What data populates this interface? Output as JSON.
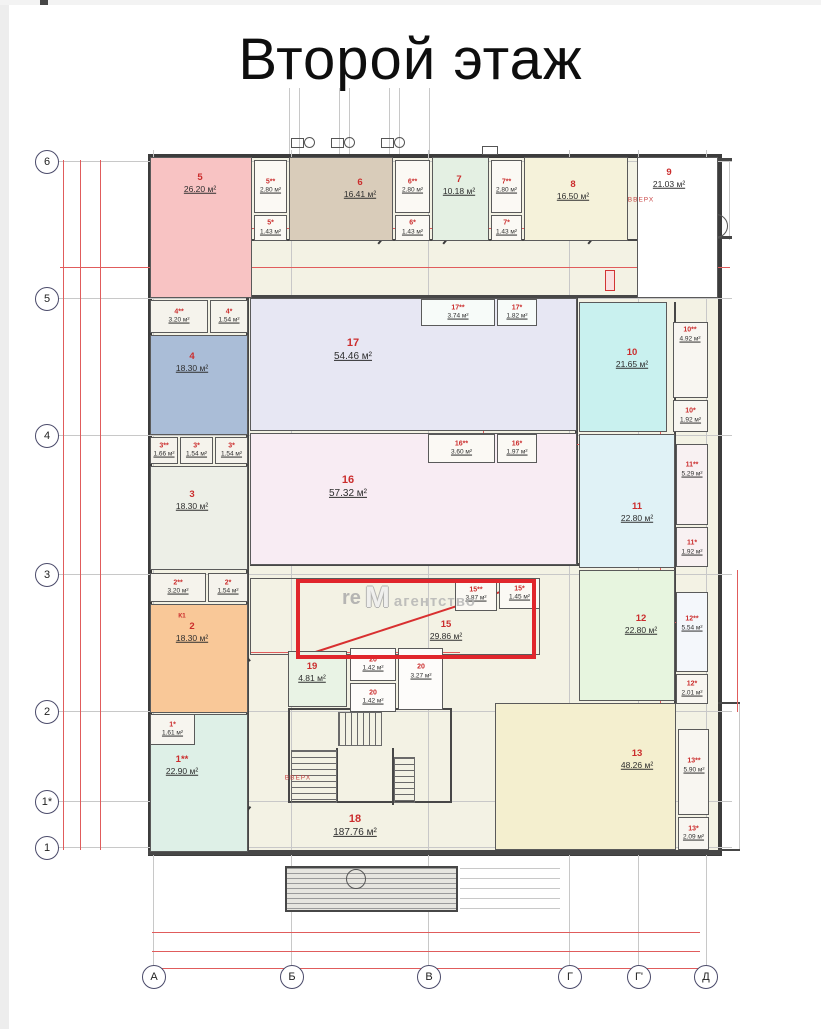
{
  "title": "Второй этаж",
  "watermark": {
    "prefix": "re",
    "logo": "M",
    "name": "агентство"
  },
  "highlight": {
    "x": 296,
    "y": 579,
    "w": 240,
    "h": 80
  },
  "axis": {
    "rows": [
      {
        "label": "6",
        "y": 162
      },
      {
        "label": "5",
        "y": 299
      },
      {
        "label": "4",
        "y": 436
      },
      {
        "label": "3",
        "y": 575
      },
      {
        "label": "2",
        "y": 712
      },
      {
        "label": "1*",
        "y": 802
      },
      {
        "label": "1",
        "y": 848
      }
    ],
    "cols": [
      {
        "label": "А",
        "x": 154
      },
      {
        "label": "Б",
        "x": 292
      },
      {
        "label": "В",
        "x": 429
      },
      {
        "label": "Г",
        "x": 570
      },
      {
        "label": "Г'",
        "x": 639
      },
      {
        "label": "Д",
        "x": 706
      }
    ]
  },
  "texts": [
    {
      "t": "ВВЕРХ",
      "x": 641,
      "y": 200,
      "cls": "vverh"
    },
    {
      "t": "ВВЕРХ",
      "x": 298,
      "y": 778,
      "cls": "vverh"
    },
    {
      "t": "К1",
      "x": 182,
      "y": 616,
      "cls": "k1"
    }
  ],
  "rooms": [
    {
      "n": "18",
      "a": "187.76 м²",
      "x": 250,
      "y": 565,
      "w": 427,
      "h": 287,
      "bg": "transparent",
      "lx": 355,
      "ly": 826,
      "sz": "l",
      "nb": true
    },
    {
      "n": "15",
      "a": "29.86 м²",
      "x": 250,
      "y": 578,
      "w": 290,
      "h": 77,
      "bg": "transparent",
      "lx": 446,
      "ly": 630,
      "sz": "m"
    },
    {
      "n": "5",
      "a": "26.20 м²",
      "x": 150,
      "y": 157,
      "w": 102,
      "h": 141,
      "bg": "#f8c3c3",
      "lx": 200,
      "ly": 183,
      "sz": "m"
    },
    {
      "n": "5**",
      "a": "2.80 м²",
      "x": 254,
      "y": 160,
      "w": 33,
      "h": 53,
      "bg": "#fbf9f4",
      "sz": "s"
    },
    {
      "n": "5*",
      "a": "1.43 м²",
      "x": 254,
      "y": 215,
      "w": 33,
      "h": 26,
      "bg": "#fbf9f4",
      "sz": "s"
    },
    {
      "n": "6",
      "a": "16.41 м²",
      "x": 289,
      "y": 157,
      "w": 104,
      "h": 84,
      "bg": "#d9ccba",
      "lx": 360,
      "ly": 188,
      "sz": "m"
    },
    {
      "n": "6**",
      "a": "2.80 м²",
      "x": 395,
      "y": 160,
      "w": 35,
      "h": 53,
      "bg": "#fbf9f4",
      "sz": "s"
    },
    {
      "n": "6*",
      "a": "1.43 м²",
      "x": 395,
      "y": 215,
      "w": 35,
      "h": 26,
      "bg": "#fbf9f4",
      "sz": "s"
    },
    {
      "n": "7",
      "a": "10.18 м²",
      "x": 432,
      "y": 157,
      "w": 57,
      "h": 84,
      "bg": "#e4f0e3",
      "lx": 459,
      "ly": 185,
      "sz": "m"
    },
    {
      "n": "7**",
      "a": "2.80 м²",
      "x": 491,
      "y": 160,
      "w": 31,
      "h": 53,
      "bg": "#fbf9f4",
      "sz": "s"
    },
    {
      "n": "7*",
      "a": "1.43 м²",
      "x": 491,
      "y": 215,
      "w": 31,
      "h": 26,
      "bg": "#fbf9f4",
      "sz": "s"
    },
    {
      "n": "8",
      "a": "16.50 м²",
      "x": 524,
      "y": 157,
      "w": 104,
      "h": 84,
      "bg": "#f5f2da",
      "lx": 573,
      "ly": 190,
      "sz": "m"
    },
    {
      "n": "9",
      "a": "21.03 м²",
      "x": 637,
      "y": 157,
      "w": 81,
      "h": 141,
      "bg": "#ffffff",
      "lx": 669,
      "ly": 178,
      "sz": "m"
    },
    {
      "n": "4**",
      "a": "3.20 м²",
      "x": 150,
      "y": 300,
      "w": 58,
      "h": 33,
      "bg": "#f5f3ec",
      "sz": "s"
    },
    {
      "n": "4*",
      "a": "1.54 м²",
      "x": 210,
      "y": 300,
      "w": 38,
      "h": 33,
      "bg": "#f5f3ec",
      "sz": "s"
    },
    {
      "n": "4",
      "a": "18.30 м²",
      "x": 150,
      "y": 335,
      "w": 98,
      "h": 100,
      "bg": "#aabdd7",
      "lx": 192,
      "ly": 362,
      "sz": "m"
    },
    {
      "n": "3**",
      "a": "1.66 м²",
      "x": 150,
      "y": 437,
      "w": 28,
      "h": 27,
      "bg": "#f5f3ec",
      "sz": "s"
    },
    {
      "n": "3*",
      "a": "1.54 м²",
      "x": 180,
      "y": 437,
      "w": 33,
      "h": 27,
      "bg": "#f5f3ec",
      "sz": "s"
    },
    {
      "n": "3*",
      "a": "1.54 м²",
      "x": 215,
      "y": 437,
      "w": 33,
      "h": 27,
      "bg": "#f5f3ec",
      "sz": "s"
    },
    {
      "n": "3",
      "a": "18.30 м²",
      "x": 150,
      "y": 466,
      "w": 98,
      "h": 104,
      "bg": "#edefe7",
      "lx": 192,
      "ly": 500,
      "sz": "m"
    },
    {
      "n": "2**",
      "a": "3.20 м²",
      "x": 150,
      "y": 573,
      "w": 56,
      "h": 29,
      "bg": "#f5f3ec",
      "sz": "s"
    },
    {
      "n": "2*",
      "a": "1.54 м²",
      "x": 208,
      "y": 573,
      "w": 40,
      "h": 29,
      "bg": "#f5f3ec",
      "sz": "s"
    },
    {
      "n": "2",
      "a": "18.30 м²",
      "x": 150,
      "y": 604,
      "w": 98,
      "h": 109,
      "bg": "#f9c898",
      "lx": 192,
      "ly": 632,
      "sz": "m"
    },
    {
      "n": "1**",
      "a": "22.90 м²",
      "x": 150,
      "y": 714,
      "w": 98,
      "h": 138,
      "bg": "#def0e7",
      "lx": 182,
      "ly": 765,
      "sz": "m"
    },
    {
      "n": "1*",
      "a": "1.61 м²",
      "x": 150,
      "y": 714,
      "w": 45,
      "h": 31,
      "bg": "#f7f5ef",
      "sz": "s"
    },
    {
      "n": "17",
      "a": "54.46 м²",
      "x": 250,
      "y": 298,
      "w": 327,
      "h": 133,
      "bg": "#e7e7f3",
      "lx": 353,
      "ly": 350,
      "sz": "l"
    },
    {
      "n": "17**",
      "a": "3.74 м²",
      "x": 421,
      "y": 299,
      "w": 74,
      "h": 27,
      "bg": "#f7fbf9",
      "sz": "s"
    },
    {
      "n": "17*",
      "a": "1.82 м²",
      "x": 497,
      "y": 299,
      "w": 40,
      "h": 27,
      "bg": "#f7fbf9",
      "sz": "s"
    },
    {
      "n": "16",
      "a": "57.32 м²",
      "x": 250,
      "y": 433,
      "w": 327,
      "h": 132,
      "bg": "#f8ecf3",
      "lx": 348,
      "ly": 487,
      "sz": "l"
    },
    {
      "n": "16**",
      "a": "3.60 м²",
      "x": 428,
      "y": 434,
      "w": 67,
      "h": 29,
      "bg": "#fbf9f4",
      "sz": "s"
    },
    {
      "n": "16*",
      "a": "1.97 м²",
      "x": 497,
      "y": 434,
      "w": 40,
      "h": 29,
      "bg": "#fbf9f4",
      "sz": "s"
    },
    {
      "n": "10",
      "a": "21.65 м²",
      "x": 579,
      "y": 302,
      "w": 88,
      "h": 130,
      "bg": "#c9f1ef",
      "lx": 632,
      "ly": 358,
      "sz": "m"
    },
    {
      "n": "10**",
      "a": "4.92 м²",
      "x": 673,
      "y": 322,
      "w": 35,
      "h": 76,
      "bg": "#f8f6f1",
      "lx": 690,
      "ly": 335,
      "sz": "s"
    },
    {
      "n": "10*",
      "a": "1.92 м²",
      "x": 673,
      "y": 400,
      "w": 35,
      "h": 32,
      "bg": "#f8f6f1",
      "sz": "s"
    },
    {
      "n": "11",
      "a": "22.80 м²",
      "x": 579,
      "y": 434,
      "w": 96,
      "h": 134,
      "bg": "#e0f2f6",
      "lx": 637,
      "ly": 512,
      "sz": "m"
    },
    {
      "n": "11**",
      "a": "5.29 м²",
      "x": 676,
      "y": 444,
      "w": 32,
      "h": 81,
      "bg": "#f8f1f2",
      "lx": 692,
      "ly": 470,
      "sz": "s"
    },
    {
      "n": "11*",
      "a": "1.92 м²",
      "x": 676,
      "y": 527,
      "w": 32,
      "h": 40,
      "bg": "#f8f1f2",
      "lx": 692,
      "ly": 548,
      "sz": "s"
    },
    {
      "n": "12",
      "a": "22.80 м²",
      "x": 579,
      "y": 570,
      "w": 96,
      "h": 131,
      "bg": "#e7f5df",
      "lx": 641,
      "ly": 624,
      "sz": "m"
    },
    {
      "n": "12**",
      "a": "5.54 м²",
      "x": 676,
      "y": 592,
      "w": 32,
      "h": 80,
      "bg": "#f4f7fb",
      "lx": 692,
      "ly": 624,
      "sz": "s"
    },
    {
      "n": "12*",
      "a": "2.01 м²",
      "x": 676,
      "y": 674,
      "w": 32,
      "h": 30,
      "bg": "#f8f6f1",
      "sz": "s"
    },
    {
      "n": "13",
      "a": "48.26 м²",
      "x": 495,
      "y": 703,
      "w": 181,
      "h": 147,
      "bg": "#f4efcf",
      "lx": 637,
      "ly": 759,
      "sz": "m"
    },
    {
      "n": "13**",
      "a": "5.90 м²",
      "x": 678,
      "y": 729,
      "w": 31,
      "h": 86,
      "bg": "#f8f6f1",
      "lx": 694,
      "ly": 766,
      "sz": "s"
    },
    {
      "n": "13*",
      "a": "2.09 м²",
      "x": 678,
      "y": 817,
      "w": 31,
      "h": 33,
      "bg": "#f8f6f1",
      "sz": "s"
    },
    {
      "n": "15**",
      "a": "3.87 м²",
      "x": 455,
      "y": 578,
      "w": 42,
      "h": 33,
      "bg": "#fbf9f4",
      "sz": "s"
    },
    {
      "n": "15*",
      "a": "1.45 м²",
      "x": 499,
      "y": 578,
      "w": 41,
      "h": 31,
      "bg": "#fbf9f4",
      "sz": "s"
    },
    {
      "n": "19",
      "a": "4.81 м²",
      "x": 288,
      "y": 651,
      "w": 59,
      "h": 56,
      "bg": "#e9f3e5",
      "lx": 312,
      "ly": 672,
      "sz": "m"
    },
    {
      "n": "20",
      "a": "1.42 м²",
      "x": 350,
      "y": 648,
      "w": 46,
      "h": 33,
      "bg": "#fdfcfa",
      "sz": "s"
    },
    {
      "n": "20",
      "a": "1.42 м²",
      "x": 350,
      "y": 683,
      "w": 46,
      "h": 29,
      "bg": "#fdfcfa",
      "sz": "s"
    },
    {
      "n": "20",
      "a": "3.27 м²",
      "x": 398,
      "y": 648,
      "w": 45,
      "h": 62,
      "bg": "#fdfcfa",
      "lx": 421,
      "ly": 672,
      "sz": "s"
    }
  ],
  "shapes": [
    {
      "c": "g",
      "x": 58,
      "y": 161,
      "w": 674,
      "h": 1
    },
    {
      "c": "g",
      "x": 58,
      "y": 298,
      "w": 674,
      "h": 1
    },
    {
      "c": "g",
      "x": 58,
      "y": 435,
      "w": 674,
      "h": 1
    },
    {
      "c": "g",
      "x": 58,
      "y": 574,
      "w": 674,
      "h": 1
    },
    {
      "c": "g",
      "x": 58,
      "y": 711,
      "w": 674,
      "h": 1
    },
    {
      "c": "g",
      "x": 58,
      "y": 801,
      "w": 674,
      "h": 1
    },
    {
      "c": "g",
      "x": 58,
      "y": 847,
      "w": 674,
      "h": 1
    },
    {
      "c": "g",
      "x": 153,
      "y": 150,
      "w": 1,
      "h": 818
    },
    {
      "c": "g",
      "x": 291,
      "y": 150,
      "w": 1,
      "h": 818
    },
    {
      "c": "g",
      "x": 428,
      "y": 150,
      "w": 1,
      "h": 818
    },
    {
      "c": "g",
      "x": 569,
      "y": 150,
      "w": 1,
      "h": 818
    },
    {
      "c": "g",
      "x": 638,
      "y": 150,
      "w": 1,
      "h": 818
    },
    {
      "c": "g",
      "x": 706,
      "y": 150,
      "w": 1,
      "h": 818
    },
    {
      "c": "g",
      "x": 289,
      "y": 88,
      "w": 1,
      "h": 66
    },
    {
      "c": "g",
      "x": 299,
      "y": 88,
      "w": 1,
      "h": 66
    },
    {
      "c": "g",
      "x": 339,
      "y": 88,
      "w": 1,
      "h": 66
    },
    {
      "c": "g",
      "x": 349,
      "y": 88,
      "w": 1,
      "h": 66
    },
    {
      "c": "g",
      "x": 389,
      "y": 88,
      "w": 1,
      "h": 66
    },
    {
      "c": "g",
      "x": 399,
      "y": 88,
      "w": 1,
      "h": 66
    },
    {
      "c": "g",
      "x": 429,
      "y": 88,
      "w": 1,
      "h": 66
    },
    {
      "c": "g",
      "x": 460,
      "y": 868,
      "w": 100,
      "h": 1
    },
    {
      "c": "g",
      "x": 460,
      "y": 878,
      "w": 100,
      "h": 1
    },
    {
      "c": "g",
      "x": 460,
      "y": 888,
      "w": 100,
      "h": 1
    },
    {
      "c": "g",
      "x": 460,
      "y": 898,
      "w": 100,
      "h": 1
    },
    {
      "c": "g",
      "x": 460,
      "y": 908,
      "w": 100,
      "h": 1
    },
    {
      "c": "g",
      "x": 739,
      "y": 702,
      "w": 1,
      "h": 149
    },
    {
      "c": "g",
      "x": 729,
      "y": 160,
      "w": 1,
      "h": 80
    },
    {
      "c": "w",
      "x": 246,
      "y": 157,
      "w": 3,
      "h": 695
    },
    {
      "c": "w",
      "x": 575,
      "y": 298,
      "w": 3,
      "h": 267
    },
    {
      "c": "w",
      "x": 674,
      "y": 302,
      "w": 2,
      "h": 548
    },
    {
      "c": "w",
      "x": 150,
      "y": 295,
      "w": 568,
      "h": 3
    },
    {
      "c": "w",
      "x": 250,
      "y": 239,
      "w": 387,
      "h": 2
    },
    {
      "c": "w",
      "x": 250,
      "y": 563,
      "w": 427,
      "h": 3
    },
    {
      "c": "w",
      "x": 148,
      "y": 850,
      "w": 572,
      "h": 5
    },
    {
      "c": "w",
      "x": 718,
      "y": 158,
      "w": 14,
      "h": 3
    },
    {
      "c": "w",
      "x": 718,
      "y": 236,
      "w": 14,
      "h": 3
    },
    {
      "c": "w",
      "x": 718,
      "y": 702,
      "w": 22,
      "h": 2
    },
    {
      "c": "w",
      "x": 718,
      "y": 849,
      "w": 22,
      "h": 2
    },
    {
      "c": "w",
      "x": 677,
      "y": 213,
      "w": 2,
      "h": 84
    },
    {
      "c": "w",
      "x": 700,
      "y": 222,
      "w": 1,
      "h": 62
    },
    {
      "c": "w",
      "x": 288,
      "y": 708,
      "w": 164,
      "h": 2
    },
    {
      "c": "w",
      "x": 288,
      "y": 801,
      "w": 164,
      "h": 2
    },
    {
      "c": "w",
      "x": 288,
      "y": 708,
      "w": 2,
      "h": 95
    },
    {
      "c": "w",
      "x": 450,
      "y": 708,
      "w": 2,
      "h": 95
    },
    {
      "c": "w",
      "x": 336,
      "y": 748,
      "w": 2,
      "h": 55
    },
    {
      "c": "w",
      "x": 392,
      "y": 748,
      "w": 2,
      "h": 57
    },
    {
      "c": "w",
      "x": 40,
      "y": 0,
      "w": 8,
      "h": 5
    },
    {
      "c": "t-h",
      "x": 640,
      "y": 213,
      "w": 76,
      "h": 84
    },
    {
      "c": "t-h",
      "x": 291,
      "y": 750,
      "w": 46,
      "h": 53
    },
    {
      "c": "t-h",
      "x": 394,
      "y": 757,
      "w": 21,
      "h": 46
    },
    {
      "c": "t-v",
      "x": 338,
      "y": 712,
      "w": 44,
      "h": 34
    },
    {
      "c": "hatch",
      "x": 285,
      "y": 866,
      "w": 173,
      "h": 46
    },
    {
      "c": "b",
      "x": 482,
      "y": 146,
      "w": 16,
      "h": 9
    },
    {
      "c": "b",
      "x": 291,
      "y": 138,
      "w": 13,
      "h": 10
    },
    {
      "c": "b",
      "x": 331,
      "y": 138,
      "w": 13,
      "h": 10
    },
    {
      "c": "b",
      "x": 381,
      "y": 138,
      "w": 13,
      "h": 10
    },
    {
      "c": "b",
      "x": 354,
      "y": 652,
      "w": 8,
      "h": 10
    },
    {
      "c": "b",
      "x": 354,
      "y": 686,
      "w": 8,
      "h": 10
    },
    {
      "c": "b",
      "x": 408,
      "y": 690,
      "w": 20,
      "h": 16
    },
    {
      "c": "c",
      "x": 304,
      "y": 137,
      "w": 11,
      "h": 11
    },
    {
      "c": "c",
      "x": 344,
      "y": 137,
      "w": 11,
      "h": 11
    },
    {
      "c": "c",
      "x": 394,
      "y": 137,
      "w": 11,
      "h": 11
    },
    {
      "c": "c",
      "x": 346,
      "y": 869,
      "w": 20,
      "h": 20
    },
    {
      "c": "c",
      "x": 704,
      "y": 214,
      "w": 24,
      "h": 24
    },
    {
      "c": "c",
      "x": 362,
      "y": 653,
      "w": 9,
      "h": 12
    },
    {
      "c": "c",
      "x": 362,
      "y": 687,
      "w": 9,
      "h": 12
    },
    {
      "c": "c",
      "x": 413,
      "y": 693,
      "w": 10,
      "h": 10
    },
    {
      "c": "rb",
      "x": 605,
      "y": 270,
      "w": 10,
      "h": 21
    },
    {
      "c": "r",
      "x": 63,
      "y": 160,
      "w": 1,
      "h": 690
    },
    {
      "c": "r",
      "x": 80,
      "y": 160,
      "w": 1,
      "h": 690
    },
    {
      "c": "r",
      "x": 100,
      "y": 160,
      "w": 1,
      "h": 690
    },
    {
      "c": "r",
      "x": 660,
      "y": 302,
      "w": 1,
      "h": 548
    },
    {
      "c": "r",
      "x": 483,
      "y": 298,
      "w": 1,
      "h": 267
    },
    {
      "c": "r",
      "x": 737,
      "y": 570,
      "w": 1,
      "h": 142
    },
    {
      "c": "r",
      "x": 150,
      "y": 228,
      "w": 478,
      "h": 1
    },
    {
      "c": "r",
      "x": 60,
      "y": 267,
      "w": 670,
      "h": 1
    },
    {
      "c": "r",
      "x": 421,
      "y": 444,
      "w": 171,
      "h": 1
    },
    {
      "c": "r",
      "x": 250,
      "y": 652,
      "w": 210,
      "h": 1
    },
    {
      "c": "r",
      "x": 580,
      "y": 622,
      "w": 128,
      "h": 1
    },
    {
      "c": "r",
      "x": 152,
      "y": 932,
      "w": 548,
      "h": 1
    },
    {
      "c": "r",
      "x": 152,
      "y": 951,
      "w": 548,
      "h": 1
    },
    {
      "c": "r",
      "x": 152,
      "y": 968,
      "w": 548,
      "h": 1
    }
  ],
  "diagonals": [
    {
      "cls": "dg",
      "x": 297,
      "y": 657,
      "l": 251,
      "r": -18
    },
    {
      "cls": "dg",
      "x": 153,
      "y": 606,
      "l": 26,
      "r": 35
    },
    {
      "cls": "dl",
      "x": 240,
      "y": 241,
      "l": 18,
      "r": -50
    },
    {
      "cls": "dl",
      "x": 378,
      "y": 243,
      "l": 18,
      "r": -50
    },
    {
      "cls": "dl",
      "x": 443,
      "y": 243,
      "l": 18,
      "r": -50
    },
    {
      "cls": "dl",
      "x": 588,
      "y": 243,
      "l": 18,
      "r": -50
    },
    {
      "cls": "dl",
      "x": 238,
      "y": 398,
      "l": 16,
      "r": 50
    },
    {
      "cls": "dl",
      "x": 290,
      "y": 545,
      "l": 16,
      "r": 55
    },
    {
      "cls": "dl",
      "x": 240,
      "y": 648,
      "l": 16,
      "r": 50
    },
    {
      "cls": "dl",
      "x": 240,
      "y": 818,
      "l": 16,
      "r": -50
    },
    {
      "cls": "dl",
      "x": 583,
      "y": 498,
      "l": 16,
      "r": 55
    },
    {
      "cls": "dl",
      "x": 584,
      "y": 655,
      "l": 16,
      "r": 55
    }
  ]
}
